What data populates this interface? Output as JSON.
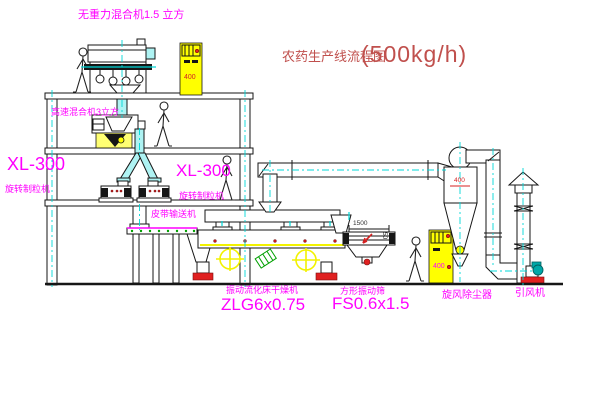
{
  "title": {
    "cn": "农药生产线流程图",
    "capacity": "(500kg/h)"
  },
  "labels": {
    "gravity_mixer": "无重力混合机1.5 立方",
    "high_speed_mixer": "高速混合机3立方",
    "granulator_left_model": "XL-300",
    "granulator_left_name": "旋转制粒机",
    "granulator_mid_model": "XL-300",
    "granulator_mid_name": "旋转制粒机",
    "belt_conveyor": "皮带输送机",
    "dryer_name": "振动流化床干燥机",
    "dryer_model": "ZLG6x0.75",
    "screen_name": "方形振动筛",
    "screen_model": "FS0.6x1.5",
    "cyclone": "旋风除尘器",
    "fan": "引风机"
  },
  "annotations": {
    "panel_top": "400",
    "panel_bottom": "400",
    "cyclone_inlet": "400",
    "screen_length": "1500",
    "screen_height": "50"
  },
  "colors": {
    "label_magenta": "#ff00ff",
    "title_red": "#c0504d",
    "centerline_cyan": "#00d8d8",
    "panel_yellow": "#ffff00",
    "line_black": "#161616",
    "status_red": "#e02020",
    "conveyor_green": "#00a000"
  }
}
